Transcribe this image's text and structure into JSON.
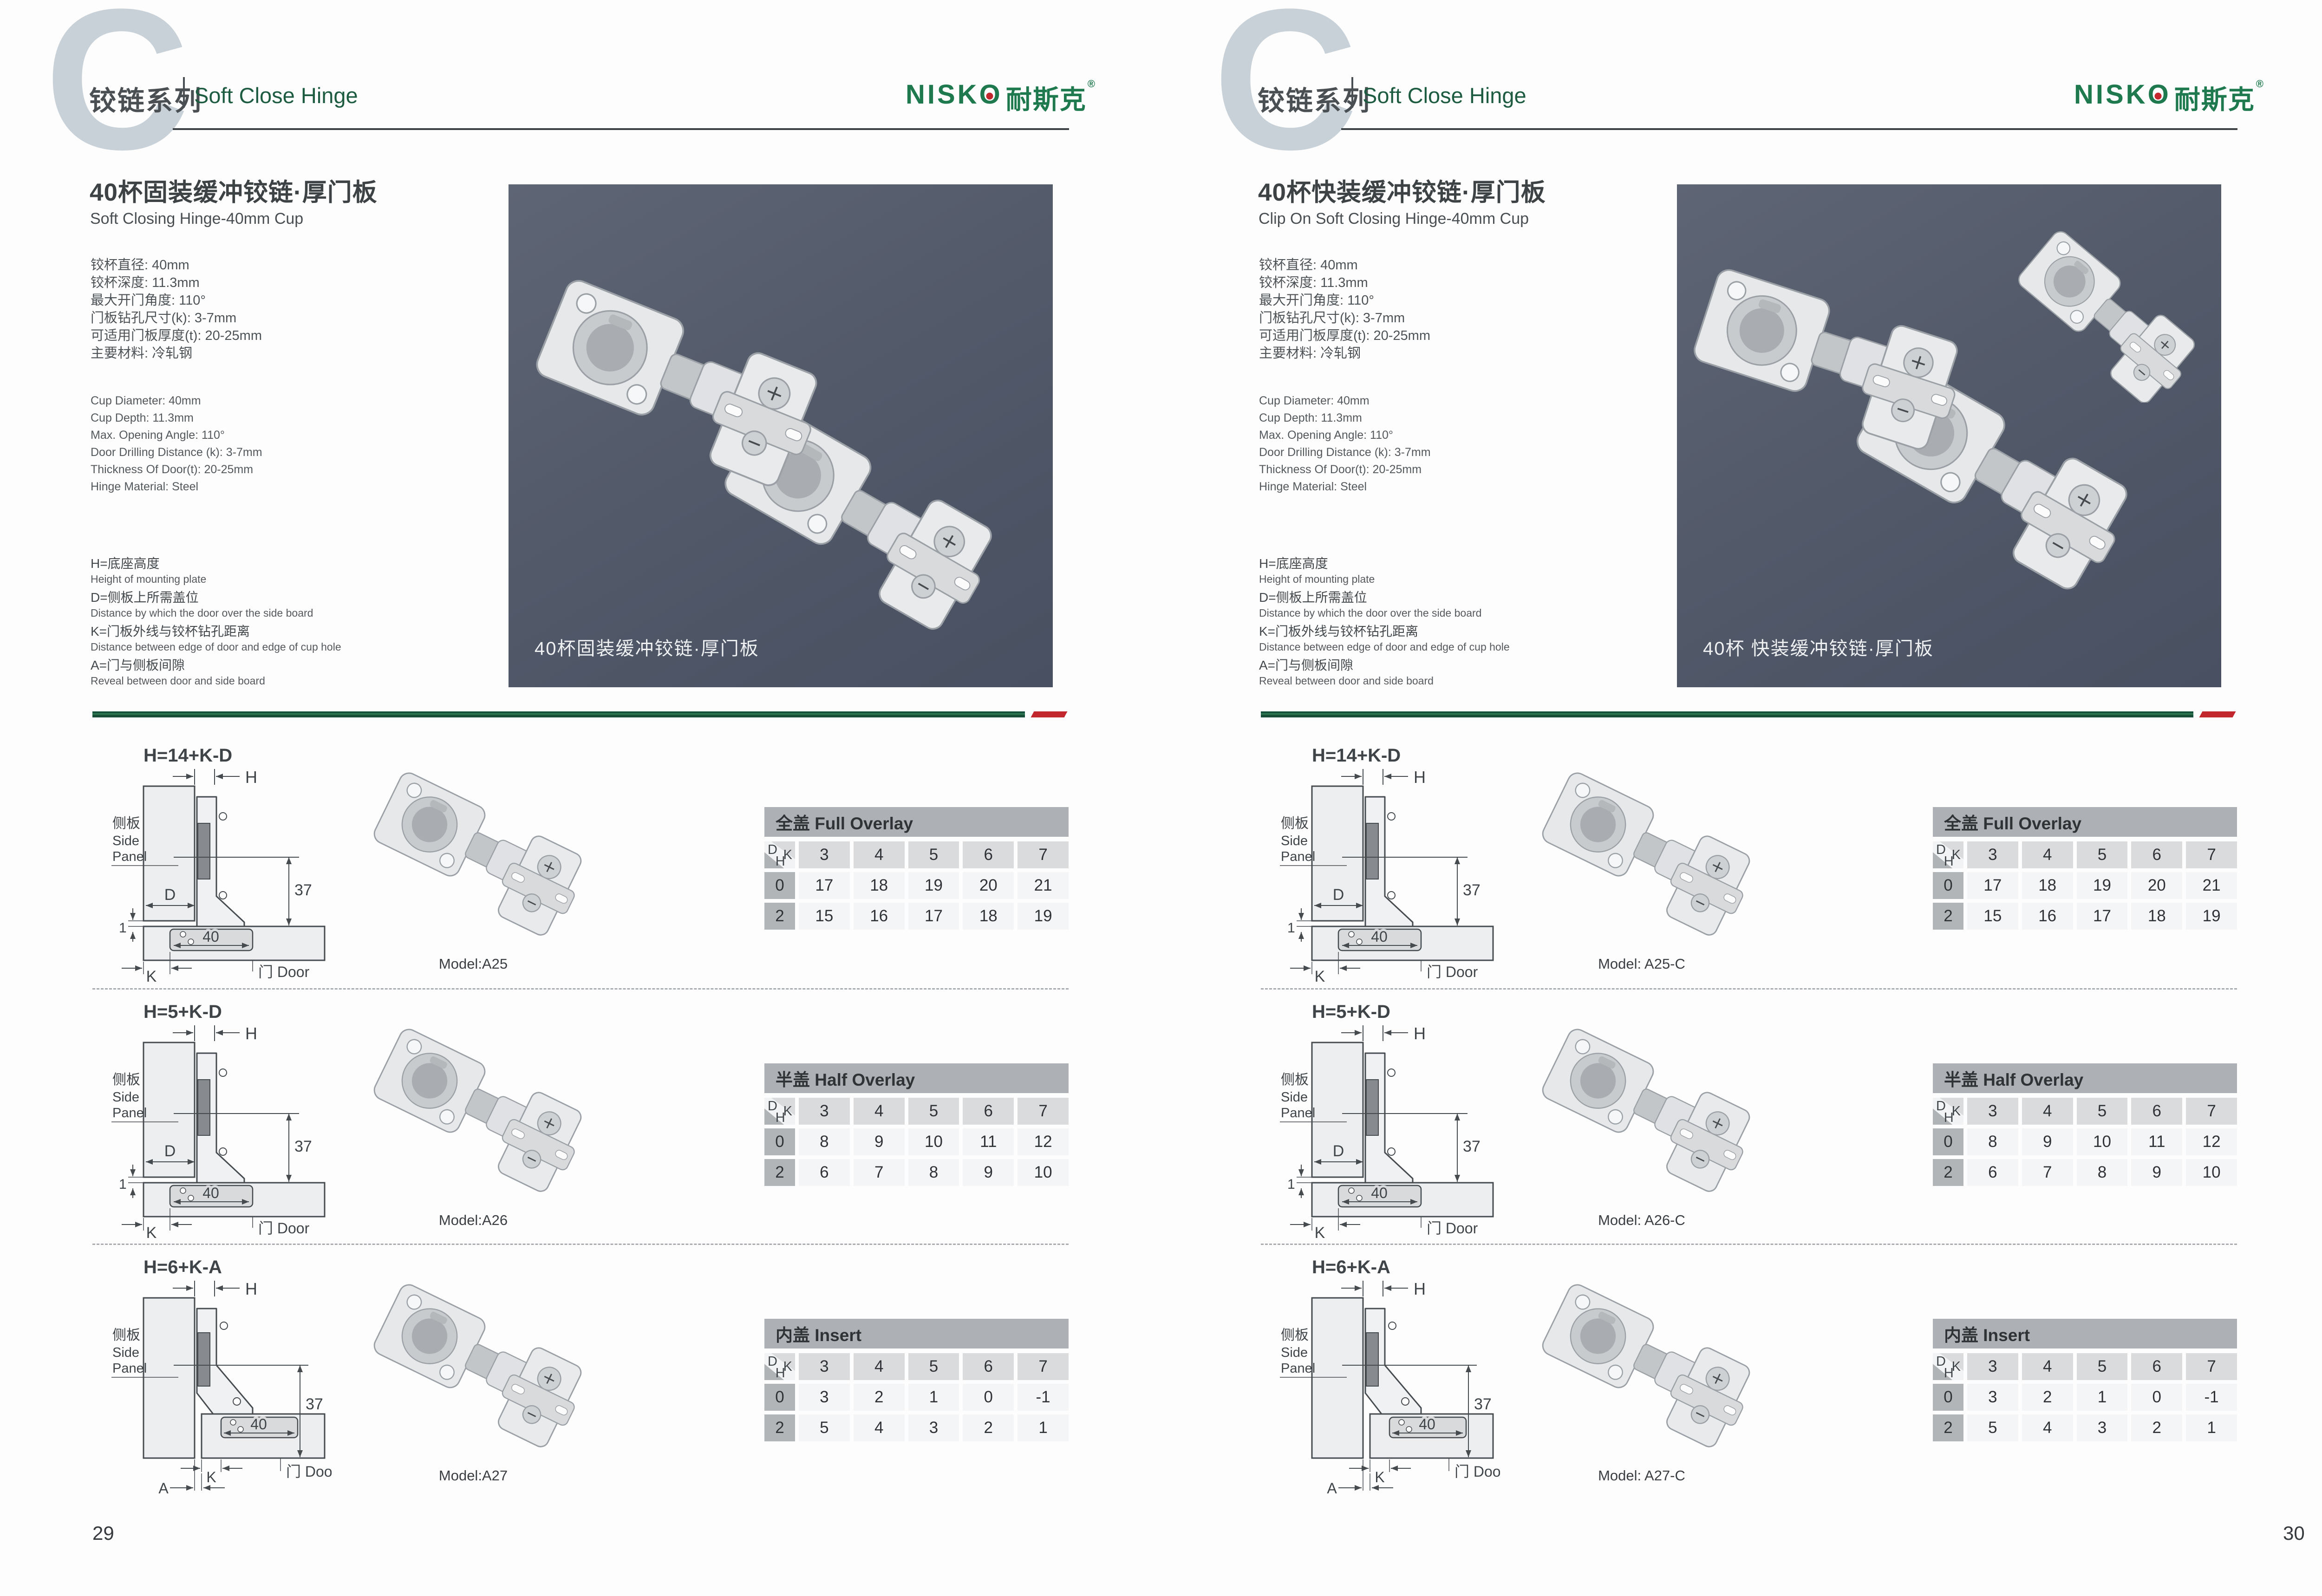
{
  "brand": {
    "logo_prefix": "NISK",
    "logo_o": "O",
    "logo_cn": "耐斯克",
    "reg": "®"
  },
  "colors": {
    "accent_green_dark": "#1d5c41",
    "logo_green": "#1e7a4e",
    "accent_red": "#c1272d",
    "photo_background": "#535a6a",
    "table_header_gray": "#adb1b5",
    "table_cell_gray": "#d9dbdd",
    "table_row_gray": "#b2b5b8"
  },
  "shared": {
    "letter_mark": "C",
    "header_cn": "铰链系列",
    "header_en": "Soft Close Hinge",
    "table_corner": {
      "d": "D",
      "k": "K",
      "h": "H"
    },
    "diagram_labels": {
      "side_panel_cn": "侧板",
      "side_panel_en_1": "Side",
      "side_panel_en_2": "Panel",
      "door": "门 Door",
      "h": "H",
      "d": "D",
      "k": "K",
      "a": "A",
      "one": "1",
      "forty": "40",
      "thirtyseven": "37"
    }
  },
  "pages": [
    {
      "page_number": "29",
      "title_cn": "40杯固装缓冲铰链·厚门板",
      "title_en": "Soft Closing Hinge-40mm Cup",
      "specs_cn": [
        "铰杯直径: 40mm",
        "铰杯深度: 11.3mm",
        "最大开门角度: 110°",
        "门板钻孔尺寸(k): 3-7mm",
        "可适用门板厚度(t): 20-25mm",
        "主要材料: 冷轧钢"
      ],
      "specs_en": [
        "Cup Diameter: 40mm",
        "Cup Depth: 11.3mm",
        "Max. Opening Angle: 110°",
        "Door Drilling Distance (k): 3-7mm",
        "Thickness Of Door(t): 20-25mm",
        "Hinge Material: Steel"
      ],
      "legend": [
        {
          "cn": "H=底座高度",
          "en": "Height of mounting plate"
        },
        {
          "cn": "D=侧板上所需盖位",
          "en": "Distance by which the door over the side board"
        },
        {
          "cn": "K=门板外线与铰杯钻孔距离",
          "en": "Distance between edge of door and edge of cup hole"
        },
        {
          "cn": "A=门与侧板间隙",
          "en": "Reveal between door and side board"
        }
      ],
      "photo_caption": "40杯固装缓冲铰链·厚门板",
      "photo_hinge_count": 2,
      "sections": [
        {
          "formula": "H=14+K-D",
          "variant": "overlay",
          "model": "Model:A25",
          "table": {
            "title": "全盖 Full Overlay",
            "k": [
              "3",
              "4",
              "5",
              "6",
              "7"
            ],
            "rows": [
              {
                "h": "0",
                "v": [
                  "17",
                  "18",
                  "19",
                  "20",
                  "21"
                ]
              },
              {
                "h": "2",
                "v": [
                  "15",
                  "16",
                  "17",
                  "18",
                  "19"
                ]
              }
            ]
          }
        },
        {
          "formula": "H=5+K-D",
          "variant": "overlay",
          "model": "Model:A26",
          "table": {
            "title": "半盖 Half Overlay",
            "k": [
              "3",
              "4",
              "5",
              "6",
              "7"
            ],
            "rows": [
              {
                "h": "0",
                "v": [
                  "8",
                  "9",
                  "10",
                  "11",
                  "12"
                ]
              },
              {
                "h": "2",
                "v": [
                  "6",
                  "7",
                  "8",
                  "9",
                  "10"
                ]
              }
            ]
          }
        },
        {
          "formula": "H=6+K-A",
          "variant": "insert",
          "model": "Model:A27",
          "table": {
            "title": "内盖 Insert",
            "k": [
              "3",
              "4",
              "5",
              "6",
              "7"
            ],
            "rows": [
              {
                "h": "0",
                "v": [
                  "3",
                  "2",
                  "1",
                  "0",
                  "-1"
                ]
              },
              {
                "h": "2",
                "v": [
                  "5",
                  "4",
                  "3",
                  "2",
                  "1"
                ]
              }
            ]
          }
        }
      ]
    },
    {
      "page_number": "30",
      "title_cn": "40杯快装缓冲铰链·厚门板",
      "title_en": "Clip On Soft Closing Hinge-40mm Cup",
      "specs_cn": [
        "铰杯直径: 40mm",
        "铰杯深度: 11.3mm",
        "最大开门角度: 110°",
        "门板钻孔尺寸(k): 3-7mm",
        "可适用门板厚度(t): 20-25mm",
        "主要材料: 冷轧钢"
      ],
      "specs_en": [
        "Cup Diameter: 40mm",
        "Cup Depth: 11.3mm",
        "Max. Opening Angle: 110°",
        "Door Drilling Distance (k): 3-7mm",
        "Thickness Of Door(t): 20-25mm",
        "Hinge Material: Steel"
      ],
      "legend": [
        {
          "cn": "H=底座高度",
          "en": "Height of mounting plate"
        },
        {
          "cn": "D=侧板上所需盖位",
          "en": "Distance by which the door over the side board"
        },
        {
          "cn": "K=门板外线与铰杯钻孔距离",
          "en": "Distance between edge of door and edge of cup hole"
        },
        {
          "cn": "A=门与侧板间隙",
          "en": "Reveal between door and side board"
        }
      ],
      "photo_caption": "40杯 快装缓冲铰链·厚门板",
      "photo_hinge_count": 3,
      "sections": [
        {
          "formula": "H=14+K-D",
          "variant": "overlay",
          "model": "Model: A25-C",
          "table": {
            "title": "全盖 Full Overlay",
            "k": [
              "3",
              "4",
              "5",
              "6",
              "7"
            ],
            "rows": [
              {
                "h": "0",
                "v": [
                  "17",
                  "18",
                  "19",
                  "20",
                  "21"
                ]
              },
              {
                "h": "2",
                "v": [
                  "15",
                  "16",
                  "17",
                  "18",
                  "19"
                ]
              }
            ]
          }
        },
        {
          "formula": "H=5+K-D",
          "variant": "overlay",
          "model": "Model: A26-C",
          "table": {
            "title": "半盖 Half Overlay",
            "k": [
              "3",
              "4",
              "5",
              "6",
              "7"
            ],
            "rows": [
              {
                "h": "0",
                "v": [
                  "8",
                  "9",
                  "10",
                  "11",
                  "12"
                ]
              },
              {
                "h": "2",
                "v": [
                  "6",
                  "7",
                  "8",
                  "9",
                  "10"
                ]
              }
            ]
          }
        },
        {
          "formula": "H=6+K-A",
          "variant": "insert",
          "model": "Model: A27-C",
          "table": {
            "title": "内盖 Insert",
            "k": [
              "3",
              "4",
              "5",
              "6",
              "7"
            ],
            "rows": [
              {
                "h": "0",
                "v": [
                  "3",
                  "2",
                  "1",
                  "0",
                  "-1"
                ]
              },
              {
                "h": "2",
                "v": [
                  "5",
                  "4",
                  "3",
                  "2",
                  "1"
                ]
              }
            ]
          }
        }
      ]
    }
  ]
}
